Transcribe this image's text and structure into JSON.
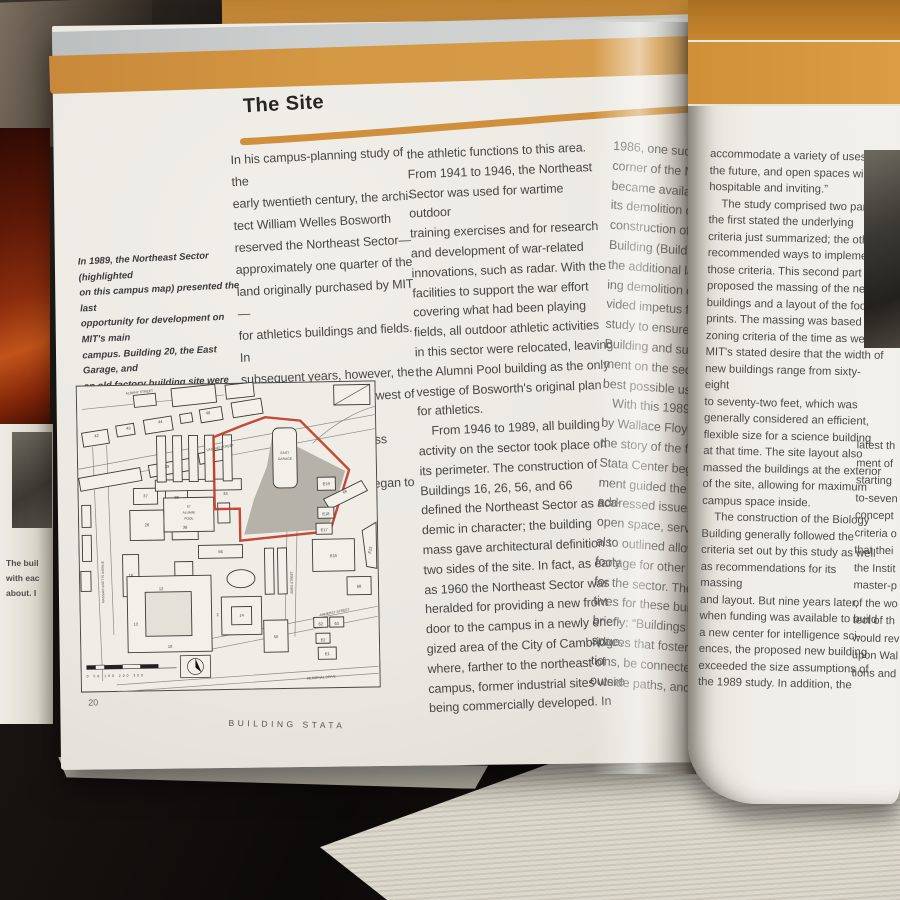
{
  "page_title": "The Site",
  "left_page": {
    "caption_lines": [
      "In 1989, the Northeast Sector (highlighted",
      "on this campus map) presented the last",
      "opportunity for development on MIT's main",
      "campus. Building 20, the East Garage, and",
      "an old factory building site were ready to",
      "be replaced by new academic buildings."
    ],
    "col1_lines": [
      "In his campus-planning study of the",
      "early twentieth century, the archi-",
      "tect William Welles Bosworth",
      "reserved the Northeast Sector—",
      "approximately one quarter of the",
      "land originally purchased by MIT—",
      "for athletics buildings and fields. In",
      "subsequent years, however, the",
      "Institute purchased land west of the",
      "original forty acres, across Massa-",
      "chusetts Avenue, and began to shift"
    ],
    "col2_lines": [
      "the athletic functions to this area.",
      "From 1941 to 1946, the Northeast",
      "Sector was used for wartime outdoor",
      "training exercises and for research",
      "and development of war-related",
      "innovations, such as radar. With the",
      "facilities to support the war effort",
      "covering what had been playing",
      "fields, all outdoor athletic activities",
      "in this sector were relocated, leaving",
      "the Alumni Pool building as the only",
      "vestige of Bosworth's original plan",
      "for athletics.",
      "    From 1946 to 1989, all building",
      "activity on the sector took place on",
      "its perimeter. The construction of",
      "Buildings 16, 26, 56, and 66",
      "defined the Northeast Sector as aca-",
      "demic in character; the building",
      "mass gave architectural definition to",
      "two sides of the site. In fact, as early",
      "as 1960 the Northeast Sector was",
      "heralded for providing a new front",
      "door to the campus in a newly ener-",
      "gized area of the City of Cambridge,",
      "where, farther to the northeast of",
      "campus, former industrial sites were",
      "being commercially developed. In"
    ],
    "gutter_col_lines": [
      "1986, one such buil",
      "corner of the North",
      "became available fo",
      "its demolition clear",
      "construction of the",
      "Building (Building 6",
      "the additional land",
      "ing demolition of Bu",
      "vided impetus for a",
      "study to ensure tha",
      "Building and subseq",
      "ment on the sector",
      "best possible use of",
      "   With this 1989 s",
      "by Wallace Floyd A",
      "the story of the fut",
      "Stata Center begin",
      "ment guided the de",
      "addressed issues su",
      "open space, service",
      "also outlined allowa",
      "footage for other b",
      "for the sector. The",
      "tives for these buil",
      "briefly: “Buildings s",
      "spaces that foster i",
      "tions, be connected",
      "outside paths, and"
    ],
    "footer": {
      "page_number": "20",
      "running_title": "BUILDING STATA"
    }
  },
  "right_page": {
    "col1_lines": [
      "accommodate a variety of uses for",
      "the future, and open spaces will be",
      "hospitable and inviting.”",
      "    The study comprised two parts:",
      "the first stated the underlying",
      "criteria just summarized; the other",
      "recommended ways to implement",
      "those criteria. This second part",
      "proposed the massing of the new",
      "buildings and a layout of the foot-",
      "prints. The massing was based on",
      "zoning criteria of the time as well as",
      "MIT's stated desire that the width of",
      "new buildings range from sixty-eight",
      "to seventy-two feet, which was",
      "generally considered an efficient,",
      "flexible size for a science building",
      "at that time. The site layout also",
      "massed the buildings at the exterior",
      "of the site, allowing for maximum",
      "campus space inside.",
      "    The construction of the Biology",
      "Building generally followed the",
      "criteria set out by this study as well",
      "as recommendations for its massing",
      "and layout. But nine years later,",
      "when funding was available to build",
      "a new center for intelligence sci-",
      "ences, the proposed new building",
      "exceeded the size assumptions of",
      "the 1989 study. In addition, the"
    ],
    "edge_col_lines": [
      "latest th",
      "ment of",
      "starting",
      "to-seven",
      "concept",
      "criteria o",
      "that thei",
      "the Instit",
      "master-p",
      "of the wo",
      "tect of th",
      "would rev",
      "upon Wal",
      "tions and"
    ]
  },
  "map": {
    "street_albany": "ALBANY STREET",
    "street_vassar": "VASSAR STREET",
    "street_mass_ave": "MASSACHUSETTS AVENUE",
    "street_ames": "AMES STREET",
    "street_amherst": "AMHERST STREET",
    "street_memorial": "MEMORIAL DRIVE",
    "east_garage": [
      "EAST",
      "GARAGE"
    ],
    "alumni_pool": [
      "57",
      "ALUMNI",
      "POOL"
    ],
    "scale_text": "0 50 100 200 300",
    "building_numbers": [
      "42",
      "43",
      "44",
      "46",
      "39",
      "37",
      "38",
      "36",
      "34",
      "26",
      "16",
      "56",
      "66",
      "68",
      "E15",
      "E17",
      "E18",
      "E19",
      "E23",
      "50",
      "14",
      "13",
      "12",
      "10",
      "62",
      "63",
      "E1",
      "E2",
      "2"
    ]
  },
  "adjacent_page": {
    "fragments": [
      "The buil",
      "with eac",
      "about. I"
    ]
  },
  "colors": {
    "band_orange": "#d2943f",
    "cover_orange": "#c9872f",
    "sector_red": "#c23a27",
    "page": "#edebe4",
    "text": "#474745"
  }
}
